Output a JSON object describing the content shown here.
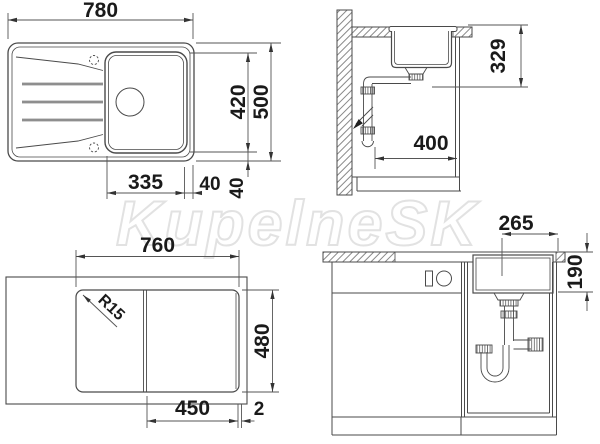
{
  "watermark": "KupelneSK",
  "palette": {
    "drawing_line": "#4a4a4a",
    "dimension_line": "#555555",
    "dimension_text": "#1a1a1a",
    "watermark_gray": "#e2e2e2"
  },
  "views": {
    "plan": {
      "overall_width": "780",
      "bowl_span": "420",
      "overall_depth": "500",
      "drainer_to_bowl": "335",
      "right_margin": "40",
      "bottom_margin": "40"
    },
    "section": {
      "depth_to_outlet": "329",
      "outlet_offset": "400"
    },
    "cutout": {
      "cutout_width": "760",
      "corner_radius": "R15",
      "cutout_depth": "480",
      "bowl_cutout_offset": "450",
      "edge_gap": "2"
    },
    "front": {
      "bowl_width": "265",
      "bowl_depth": "190"
    }
  }
}
